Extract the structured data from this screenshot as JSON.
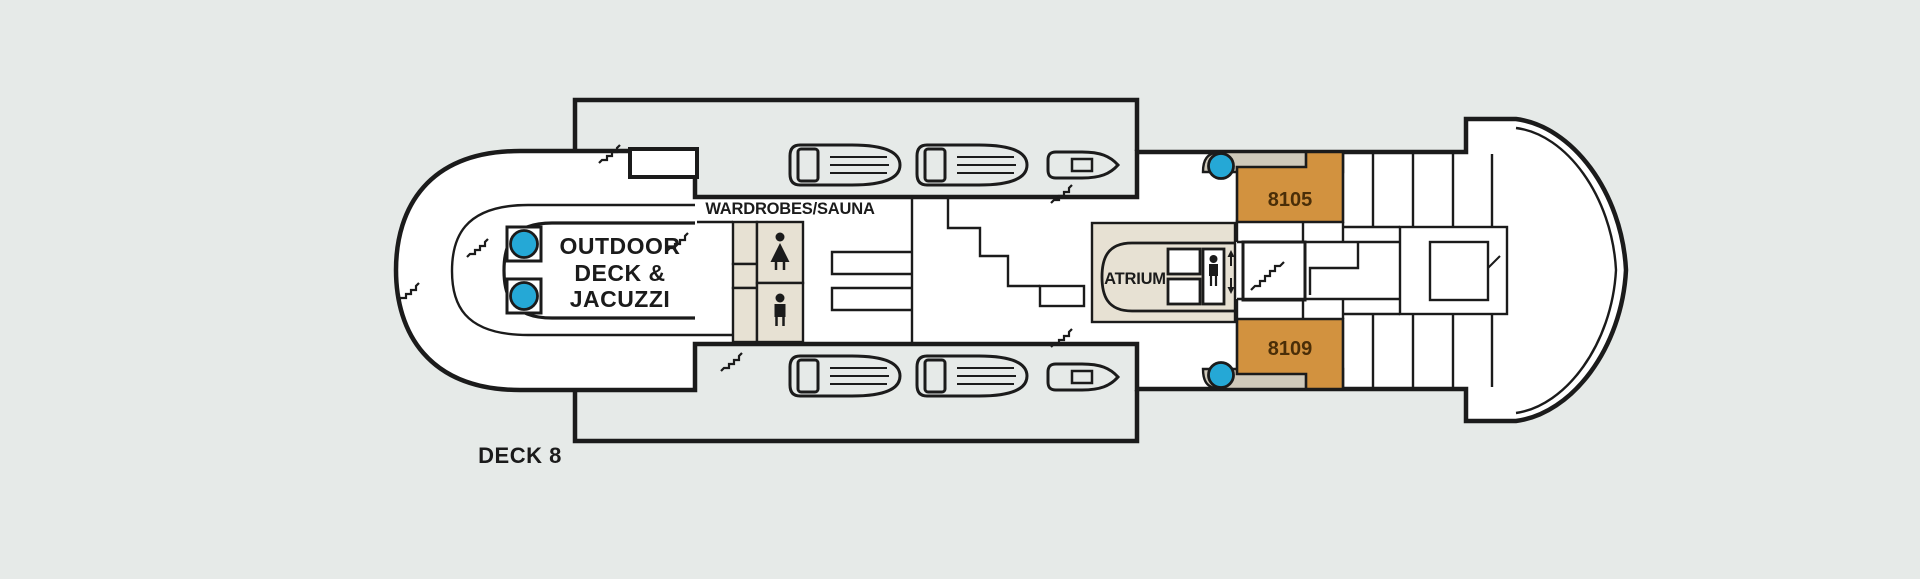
{
  "deck_plan": {
    "title": "DECK 8",
    "areas": {
      "outdoor_deck": {
        "line1": "OUTDOOR",
        "line2": "DECK &",
        "line3": "JACUZZI"
      },
      "wardrobes_sauna": {
        "label": "WARDROBES/SAUNA"
      },
      "atrium": {
        "label": "ATRIUM"
      }
    },
    "cabins": [
      {
        "number": "8105"
      },
      {
        "number": "8109"
      }
    ],
    "icons": {
      "jacuzzi-icon": "filled blue circle in square frame",
      "lifeboat-icon": "outlined lifeboat with launch sled and plank lines",
      "tender-boat-icon": "small outlined boat with cabin rectangle",
      "staircase-icon": "small zigzag step line",
      "stairwell-icon": "stepped flight inside white box",
      "elevator-icon": "person in box with up and down arrows",
      "sauna-female-icon": "female pictogram",
      "sauna-male-icon": "male pictogram"
    },
    "colors": {
      "background": "#e6eae8",
      "line": "#1b1b1b",
      "deck_white": "#ffffff",
      "interior_beige": "#e7e1d3",
      "balcony_taupe": "#cfc9ba",
      "cabin_orange": "#d2923f",
      "cabin_number_brown": "#4a2e08",
      "jacuzzi_blue": "#25a8d6"
    }
  }
}
